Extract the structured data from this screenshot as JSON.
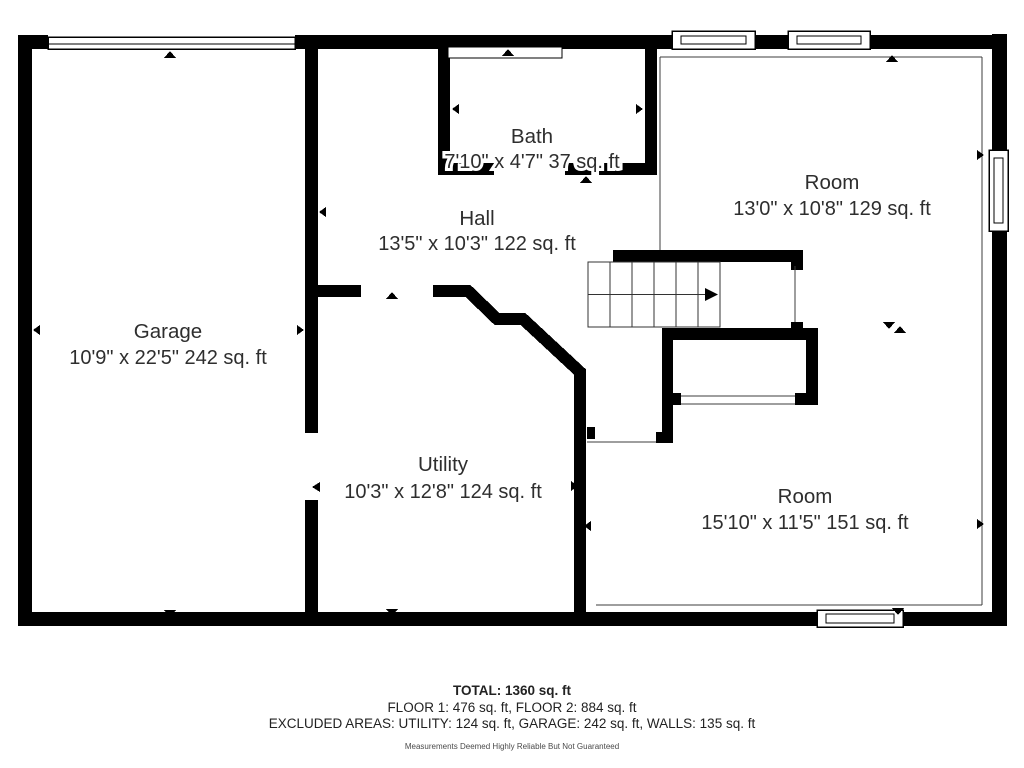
{
  "floorplan": {
    "rooms": [
      {
        "name": "Garage",
        "dimensions": "10'9\" x 22'5\" 242 sq. ft"
      },
      {
        "name": "Bath",
        "dimensions": "7'10\" x 4'7\" 37 sq. ft"
      },
      {
        "name": "Hall",
        "dimensions": "13'5\" x 10'3\" 122 sq. ft"
      },
      {
        "name": "Room",
        "dimensions": "13'0\" x 10'8\" 129 sq. ft"
      },
      {
        "name": "Utility",
        "dimensions": "10'3\" x 12'8\" 124 sq. ft"
      },
      {
        "name": "Room",
        "dimensions": "15'10\" x 11'5\" 151 sq. ft"
      }
    ],
    "colors": {
      "wall": "#000000",
      "background": "#ffffff",
      "text": "#2e2e2e"
    }
  },
  "summary": {
    "total": "TOTAL: 1360 sq. ft",
    "floors": "FLOOR 1: 476 sq. ft, FLOOR 2: 884 sq. ft",
    "excluded": "EXCLUDED AREAS: UTILITY: 124 sq. ft, GARAGE: 242 sq. ft, WALLS: 135 sq. ft",
    "disclaimer": "Measurements Deemed Highly Reliable But Not Guaranteed"
  }
}
